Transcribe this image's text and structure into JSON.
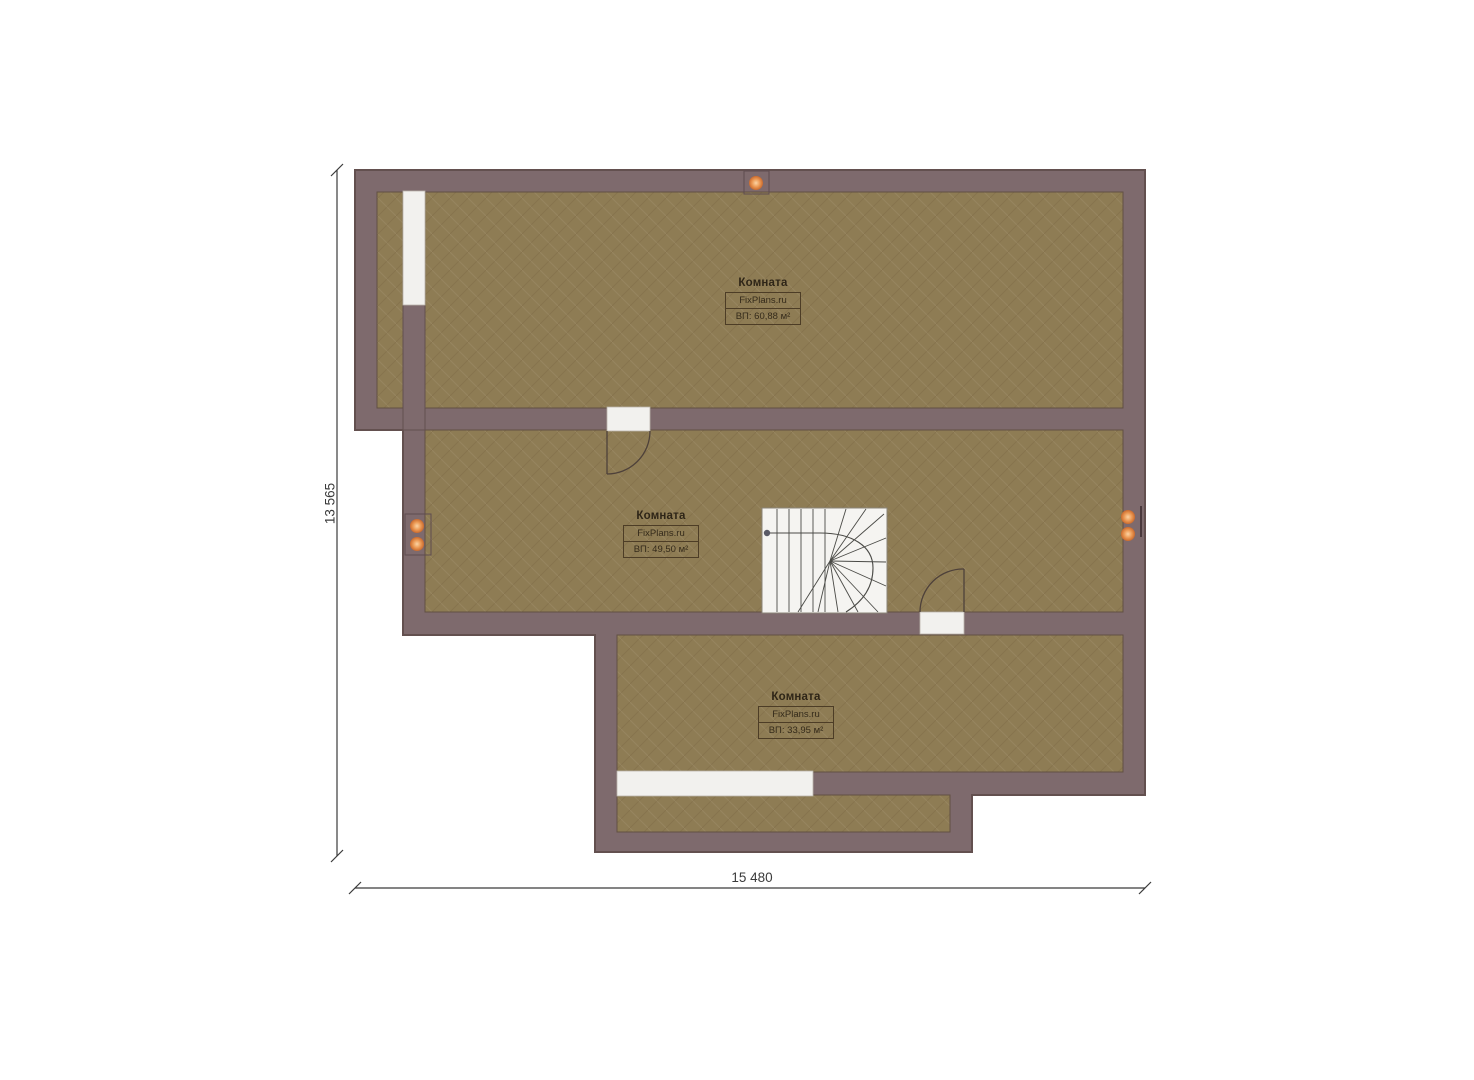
{
  "plan": {
    "rooms": [
      {
        "name": "Комната",
        "watermark": "FixPlans.ru",
        "area_label": "ВП: 60,88 м²"
      },
      {
        "name": "Комната",
        "watermark": "FixPlans.ru",
        "area_label": "ВП: 49,50 м²"
      },
      {
        "name": "Комната",
        "watermark": "FixPlans.ru",
        "area_label": "ВП: 33,95 м²"
      }
    ],
    "dimensions": {
      "left_total": "13 565",
      "bottom_total": "15 480"
    },
    "colors": {
      "background": "#ffffff",
      "wall_fill": "#7e6a6d",
      "wall_outline": "#63504f",
      "floor_fill": "#8e7c54",
      "floor_outline": "#615043",
      "opening_fill": "#f2f1ee",
      "stair_fill": "#f5f4f1",
      "stair_line": "#4a4a46",
      "door_line": "#4e413a",
      "outlet_marker": "#e8914f",
      "dimension_line": "#3b3b3b"
    }
  }
}
